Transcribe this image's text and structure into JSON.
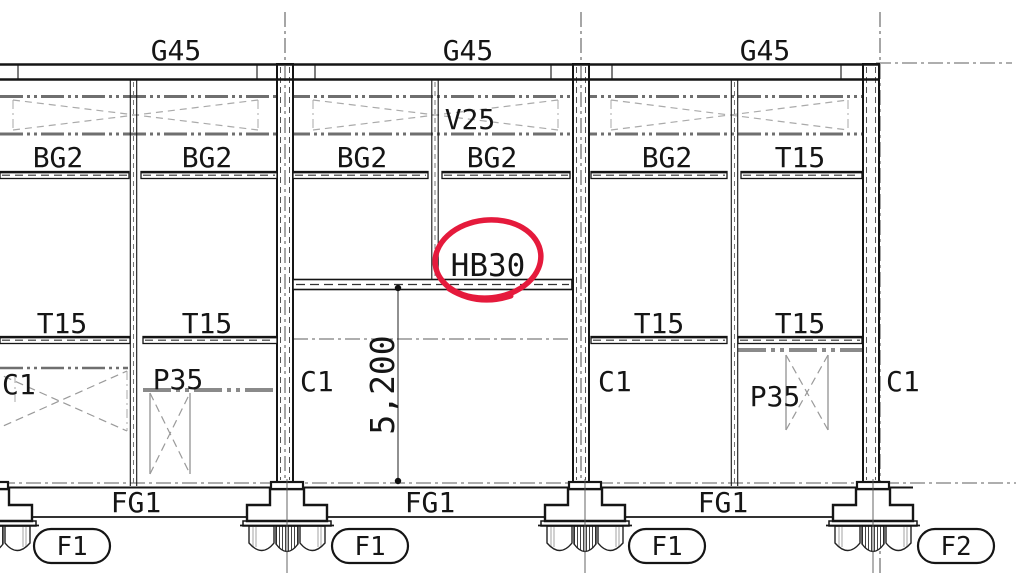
{
  "labels": {
    "roof_girders": [
      "G45",
      "G45",
      "G45"
    ],
    "vent_beam": "V25",
    "upper_beams": [
      "BG2",
      "BG2",
      "BG2",
      "BG2",
      "BG2",
      "T15"
    ],
    "hanging_beam": "HB30",
    "tie_beams": [
      "T15",
      "T15",
      "T15",
      "T15"
    ],
    "columns": [
      "C1",
      "C1",
      "C1",
      "C1"
    ],
    "piers": [
      "P35",
      "P35"
    ],
    "dimension": "5,200",
    "foundation_girders": [
      "FG1",
      "FG1",
      "FG1"
    ],
    "footing_tags": [
      "F1",
      "F1",
      "F1",
      "F2"
    ]
  },
  "colors": {
    "marker_red": "#e51a3c",
    "line_black": "#151515",
    "line_gray": "#8a8a8a"
  }
}
